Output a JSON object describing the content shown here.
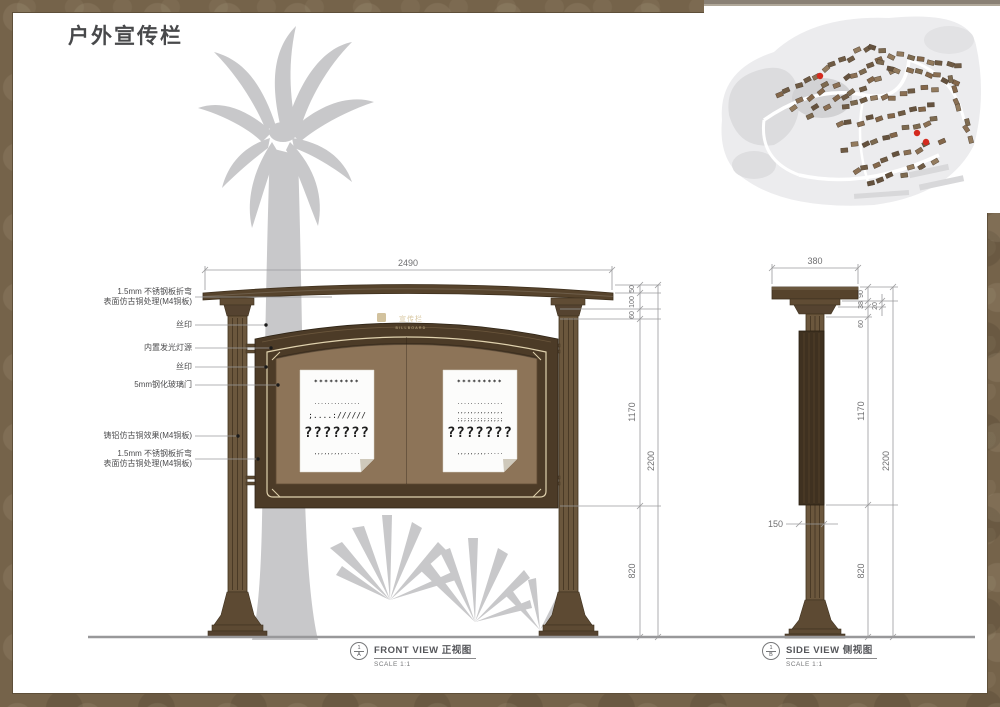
{
  "page": {
    "title": "户外宣传栏"
  },
  "colors": {
    "frame": "#75634a",
    "wood_dark": "#4c3b27",
    "wood_mid": "#6b573d",
    "panel": "#8d7458",
    "cream": "#e0d2ae",
    "silhouette": "#c8c8ca",
    "dim_line": "#9a9a9c",
    "dim_text": "#6f6f71",
    "marker_red": "#d42a1e"
  },
  "front_view": {
    "board_logo": "宣传栏",
    "board_logo_sub": "BILLBOARD",
    "dim_width": "2490",
    "dims_right": [
      "50",
      "100",
      "60",
      "1170",
      "820"
    ],
    "dim_overall": "2200",
    "caption": {
      "en": "FRONT VIEW",
      "zh": "正视图",
      "scale": "SCALE 1:1",
      "ref_top": "1",
      "ref_bottom": "A"
    },
    "posters": [
      {
        "lines": [
          "*********",
          "..............",
          ";....://////",
          "???????",
          ",,,,,,,,,....."
        ]
      },
      {
        "lines": [
          "*********",
          "..............",
          ",,,,,,,,,,,,,,",
          ";;;;;;;;;;;;;;",
          "???????",
          ",,,,,,,,,....."
        ]
      }
    ]
  },
  "side_view": {
    "dim_width": "380",
    "dims_right": [
      "90",
      "38",
      "20",
      "60",
      "1170",
      "820"
    ],
    "dim_overall": "2200",
    "dim_pole": "150",
    "caption": {
      "en": "SIDE VIEW",
      "zh": "侧视图",
      "scale": "SCALE 1:1",
      "ref_top": "1",
      "ref_bottom": "B"
    }
  },
  "annotations": [
    {
      "lines": [
        "1.5mm 不锈钢板折弯",
        "表面仿古铜处理(M4铜板)"
      ]
    },
    {
      "lines": [
        "丝印"
      ]
    },
    {
      "lines": [
        "内置发光灯源"
      ]
    },
    {
      "lines": [
        "丝印"
      ]
    },
    {
      "lines": [
        "5mm钢化玻璃门"
      ]
    },
    {
      "lines": [
        "铸铝仿古铜效果(M4铜板)"
      ]
    },
    {
      "lines": [
        "1.5mm 不锈钢板折弯",
        "表面仿古铜处理(M4铜板)"
      ]
    }
  ],
  "map": {
    "markers": [
      {
        "x": 116,
        "y": 76
      },
      {
        "x": 213,
        "y": 133
      },
      {
        "x": 222,
        "y": 142
      }
    ]
  }
}
